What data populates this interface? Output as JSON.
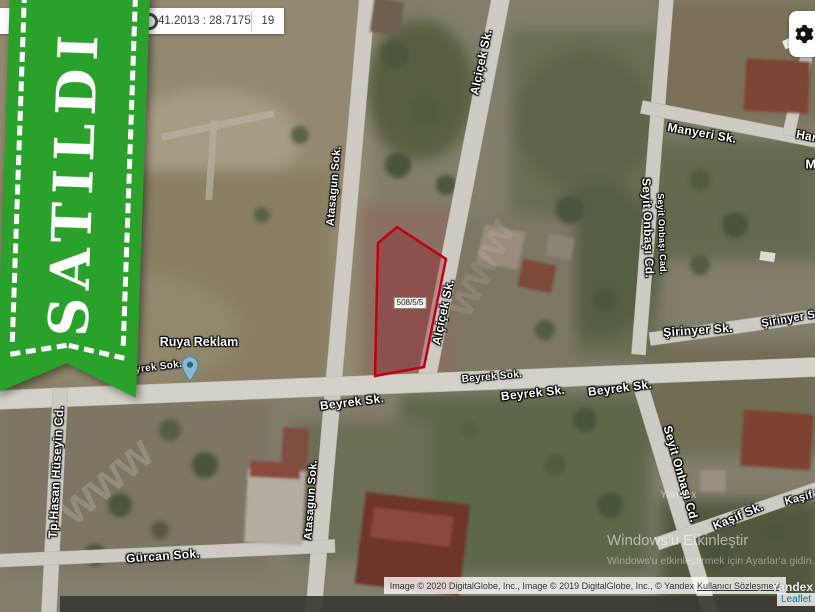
{
  "ribbon": {
    "text": "SATILDI",
    "color": "#2aa12b"
  },
  "topbar": {
    "coordinates": "41.2013 : 28.7175",
    "zoom_level": "19"
  },
  "map": {
    "parcel": {
      "label": "508/5/5",
      "outline_color": "#c00018"
    },
    "poi": {
      "name": "Ruya Reklam"
    },
    "street_labels": [
      {
        "text": "Alçiçek Sk.",
        "x": 481,
        "y": 62,
        "rot": -78,
        "size": 12
      },
      {
        "text": "Alçiçek Sk.",
        "x": 443,
        "y": 312,
        "rot": -78,
        "size": 12
      },
      {
        "text": "Atasagun Sok.",
        "x": 334,
        "y": 186,
        "rot": -85,
        "size": 11
      },
      {
        "text": "Atasagun Sok.",
        "x": 311,
        "y": 500,
        "rot": -86,
        "size": 11
      },
      {
        "text": "Beyrek Sok.",
        "x": 152,
        "y": 368,
        "rot": -7,
        "size": 10
      },
      {
        "text": "Beyrek Sk.",
        "x": 352,
        "y": 402,
        "rot": -7,
        "size": 12
      },
      {
        "text": "Beyrek Sok.",
        "x": 492,
        "y": 377,
        "rot": -5,
        "size": 10
      },
      {
        "text": "Beyrek Sk.",
        "x": 533,
        "y": 393,
        "rot": -6,
        "size": 12
      },
      {
        "text": "Beyrek Sk.",
        "x": 620,
        "y": 388,
        "rot": -7,
        "size": 12
      },
      {
        "text": "Manyeri Sk.",
        "x": 702,
        "y": 133,
        "rot": 10,
        "size": 12
      },
      {
        "text": "Seyit Onbaşı Cd.",
        "x": 648,
        "y": 228,
        "rot": 88,
        "size": 12
      },
      {
        "text": "Seyit Onbaşı Cad.",
        "x": 662,
        "y": 234,
        "rot": 88,
        "size": 9
      },
      {
        "text": "Şirinyer Sk.",
        "x": 698,
        "y": 330,
        "rot": -4,
        "size": 12
      },
      {
        "text": "Şirinyer Sok",
        "x": 795,
        "y": 318,
        "rot": -10,
        "size": 11
      },
      {
        "text": "Seyit Onbaşı Cd.",
        "x": 681,
        "y": 474,
        "rot": 74,
        "size": 12
      },
      {
        "text": "Kaşif Sk.",
        "x": 738,
        "y": 516,
        "rot": -23,
        "size": 12
      },
      {
        "text": "Kaşif S",
        "x": 804,
        "y": 497,
        "rot": -15,
        "size": 11
      },
      {
        "text": "Tp.Hasan Hüseyin Cd.",
        "x": 56,
        "y": 472,
        "rot": -87,
        "size": 12
      },
      {
        "text": "Gürcan Sok.",
        "x": 163,
        "y": 556,
        "rot": -4,
        "size": 12
      },
      {
        "text": "Han",
        "x": 808,
        "y": 136,
        "rot": 10,
        "size": 12
      },
      {
        "text": "M",
        "x": 811,
        "y": 164,
        "rot": 0,
        "size": 13
      }
    ]
  },
  "watermarks": {
    "windows_line1": "Windows'u Etkinleştir",
    "windows_line2": "Windows'u etkinleştirmek için Ayarlar'a gidin.",
    "yandex": "Yandex",
    "fragments": [
      {
        "text": "www",
        "x": 105,
        "y": 480,
        "rot": -40,
        "size": 46,
        "opacity": 0.16
      },
      {
        "text": "www",
        "x": 480,
        "y": 268,
        "rot": -62,
        "size": 44,
        "opacity": 0.1
      }
    ]
  },
  "attribution": {
    "text": "Image © 2020 DigitalGlobe, Inc., Image © 2019 DigitalGlobe, Inc., © Yandex ",
    "link": "Kullanıcı Sözleşmesi",
    "yandex_logo": "Yandex",
    "leaflet": "Leaflet"
  }
}
